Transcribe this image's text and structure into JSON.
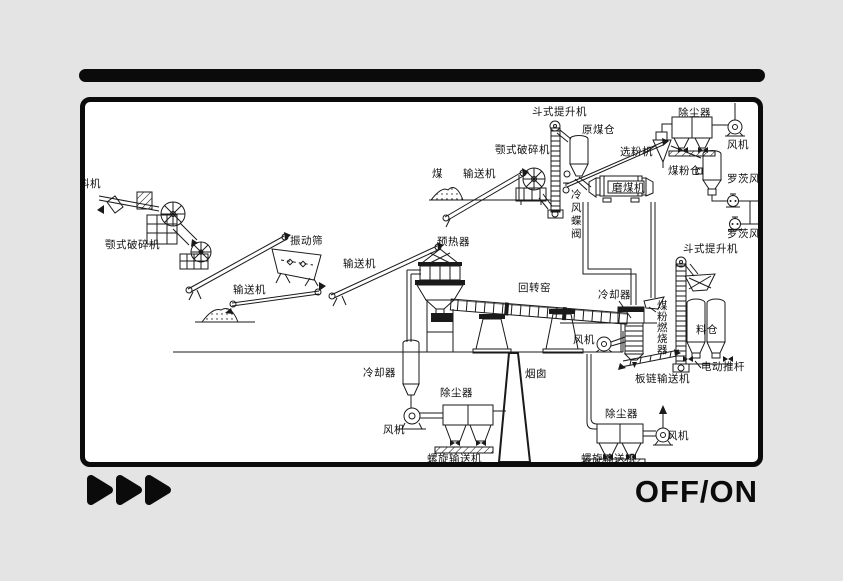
{
  "colors": {
    "background": "#e4e4e4",
    "ink": "#1a1a1a",
    "frame_fill": "#ffffff"
  },
  "player": {
    "onoff_label": "OFF/ON",
    "fast_forward_icon": "triple-right-triangles"
  },
  "diagram": {
    "description": "Cement production line process flow diagram",
    "labels": [
      {
        "id": "feeder",
        "text": "料机",
        "x": -6,
        "y": 85
      },
      {
        "id": "jaw-crusher-left",
        "text": "颚式破碎机",
        "x": 20,
        "y": 146
      },
      {
        "id": "vibrating-screen",
        "text": "振动筛",
        "x": 205,
        "y": 142
      },
      {
        "id": "conveyor-1",
        "text": "输送机",
        "x": 148,
        "y": 191
      },
      {
        "id": "conveyor-2",
        "text": "输送机",
        "x": 258,
        "y": 165
      },
      {
        "id": "preheater",
        "text": "预热器",
        "x": 352,
        "y": 143
      },
      {
        "id": "coal",
        "text": "煤",
        "x": 347,
        "y": 75
      },
      {
        "id": "conveyor-3",
        "text": "输送机",
        "x": 378,
        "y": 75
      },
      {
        "id": "jaw-crusher-coal",
        "text": "颚式破碎机",
        "x": 410,
        "y": 51
      },
      {
        "id": "bucket-elevator-1",
        "text": "斗式提升机",
        "x": 447,
        "y": 13
      },
      {
        "id": "raw-coal-bunker",
        "text": "原煤仓",
        "x": 497,
        "y": 31
      },
      {
        "id": "classifier",
        "text": "选粉机",
        "x": 535,
        "y": 53
      },
      {
        "id": "dust-collector-1",
        "text": "除尘器",
        "x": 593,
        "y": 14
      },
      {
        "id": "fan-1",
        "text": "风机",
        "x": 642,
        "y": 46
      },
      {
        "id": "coal-mill",
        "text": "磨煤机",
        "x": 527,
        "y": 89
      },
      {
        "id": "coal-powder-bunker",
        "text": "煤粉仓",
        "x": 583,
        "y": 72
      },
      {
        "id": "roots-blower-1",
        "text": "罗茨风机",
        "x": 642,
        "y": 80
      },
      {
        "id": "roots-blower-2",
        "text": "罗茨风机",
        "x": 642,
        "y": 135
      },
      {
        "id": "cold-air-butterfly-valve",
        "text": "冷风蝶阀",
        "x": 486,
        "y": 96,
        "vertical": true,
        "dy": 13
      },
      {
        "id": "rotary-kiln",
        "text": "回转窑",
        "x": 433,
        "y": 189
      },
      {
        "id": "cooler-kiln",
        "text": "冷却器",
        "x": 513,
        "y": 196
      },
      {
        "id": "bucket-elevator-2",
        "text": "斗式提升机",
        "x": 598,
        "y": 150
      },
      {
        "id": "coal-powder-burner",
        "text": "煤粉燃烧器",
        "x": 572,
        "y": 207,
        "vertical": true,
        "dy": 11
      },
      {
        "id": "silo",
        "text": "料仓",
        "x": 611,
        "y": 231
      },
      {
        "id": "electric-push-rod",
        "text": "电动推杆",
        "x": 616,
        "y": 268
      },
      {
        "id": "plate-chain-conveyor",
        "text": "板链输送机",
        "x": 550,
        "y": 280
      },
      {
        "id": "fan-kiln",
        "text": "风机",
        "x": 488,
        "y": 241
      },
      {
        "id": "cooler-left",
        "text": "冷却器",
        "x": 278,
        "y": 274
      },
      {
        "id": "fan-left",
        "text": "风机",
        "x": 298,
        "y": 331
      },
      {
        "id": "dust-collector-2",
        "text": "除尘器",
        "x": 355,
        "y": 294
      },
      {
        "id": "screw-conveyor-1",
        "text": "螺旋输送机",
        "x": 342,
        "y": 360
      },
      {
        "id": "chimney",
        "text": "烟囱",
        "x": 440,
        "y": 275
      },
      {
        "id": "dust-collector-3",
        "text": "除尘器",
        "x": 520,
        "y": 315
      },
      {
        "id": "fan-right",
        "text": "风机",
        "x": 582,
        "y": 337
      },
      {
        "id": "screw-conveyor-2",
        "text": "螺旋输送机",
        "x": 496,
        "y": 360
      }
    ]
  }
}
